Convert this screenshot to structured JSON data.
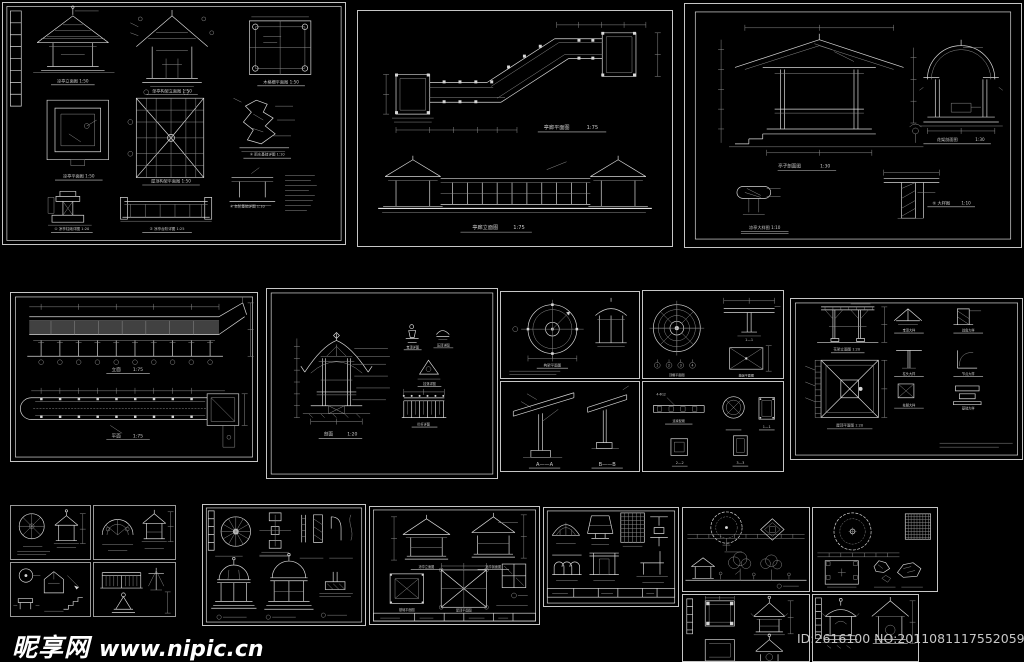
{
  "page": {
    "background": "#000000",
    "line_color": "#d8d8d8",
    "dim_line_color": "#8d8d8d",
    "watermark_color": "#ffffff",
    "id_text_color": "#c7c7c7"
  },
  "watermark": {
    "site_name": "昵享网",
    "site_url": "www.nipic.cn"
  },
  "image_id_text": "ID:2616100 NO:20110811175520595000",
  "sheets": {
    "s1": {
      "elev": "凉亭立面图 1:50",
      "frame_elev": "单亭构架立面图 1:50",
      "grille_plan": "木格栅平面图 1:50",
      "plan": "凉亭平面图 1:50",
      "roof_plan": "屋顶构架平面图 1:50",
      "d1": "① 凉亭柱础详图 1:20",
      "d2": "② 凉亭台阶详图 1:25",
      "d3": "③ 雨水基础详图 1:10",
      "d4": "④ 台阶基础详图 1:10"
    },
    "s2": {
      "plan": "亭廊平面图",
      "plan_scale": "1:75",
      "elev": "亭廊立面图",
      "elev_scale": "1:75"
    },
    "s3": {
      "section": "亭子剖面图",
      "section_scale": "1:30",
      "arch": "花架剖面图",
      "arch_scale": "1:30",
      "detail5": "⑤ 大样图",
      "detail5_scale": "1:10",
      "big_detail": "凉亭大样图 1:10"
    },
    "s4": {
      "elev": "立面",
      "elev_scale": "1:75",
      "plan": "平面",
      "plan_scale": "1:75"
    },
    "s5": {
      "section": "剖面",
      "section_scale": "1:20",
      "d1": "宝顶详图",
      "d2": "压顶详图",
      "d3": "挂落详图",
      "rail": "栏杆详图"
    },
    "s6a": {
      "plan": "构架平面图"
    },
    "s6b": {
      "plan": "顶棚平面图",
      "sec1": "1—1",
      "base": "基础平面图",
      "bubbles": [
        "1",
        "2",
        "3",
        "4"
      ]
    },
    "s6c": {
      "a": "A——A",
      "b": "B——B"
    },
    "s6d": {
      "beam": "连梁配筋",
      "ann": "4-Φ12",
      "s1": "1—1",
      "s2": "2—2",
      "s3": "3—3"
    },
    "s7": {
      "elev": "花架立面图 1:20",
      "roof_plan": "屋顶平面图 1:20",
      "details": [
        "宝顶大样",
        "戗角大样",
        "柱头大样",
        "节点大样",
        "柱脚大样",
        "基础大样"
      ]
    },
    "s10": {
      "l1": "凉亭立面图",
      "l2": "凉亭剖面图",
      "p1": "基础平面图",
      "p2": "屋顶平面图"
    }
  }
}
